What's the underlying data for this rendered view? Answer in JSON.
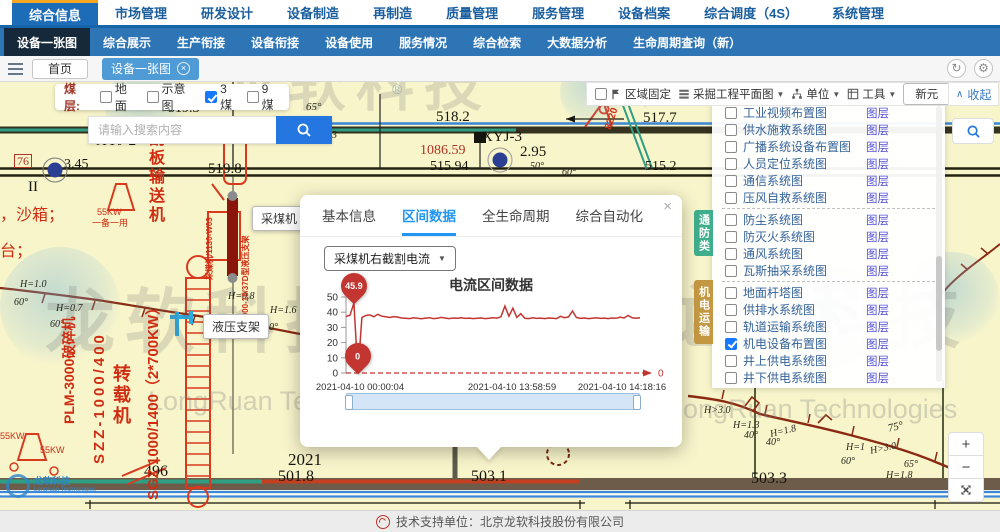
{
  "window": {
    "refresh_icon": "↻",
    "gear_icon": "⚙"
  },
  "top_nav": {
    "items": [
      {
        "label": "综合信息",
        "active": true
      },
      {
        "label": "市场管理",
        "active": false
      },
      {
        "label": "研发设计",
        "active": false
      },
      {
        "label": "设备制造",
        "active": false
      },
      {
        "label": "再制造",
        "active": false
      },
      {
        "label": "质量管理",
        "active": false
      },
      {
        "label": "服务管理",
        "active": false
      },
      {
        "label": "设备档案",
        "active": false
      },
      {
        "label": "综合调度（4S）",
        "active": false
      },
      {
        "label": "系统管理",
        "active": false
      }
    ]
  },
  "sub_nav": {
    "items": [
      {
        "label": "设备一张图",
        "active": true
      },
      {
        "label": "综合展示",
        "active": false
      },
      {
        "label": "生产衔接",
        "active": false
      },
      {
        "label": "设备衔接",
        "active": false
      },
      {
        "label": "设备使用",
        "active": false
      },
      {
        "label": "服务情况",
        "active": false
      },
      {
        "label": "综合检索",
        "active": false
      },
      {
        "label": "大数据分析",
        "active": false
      },
      {
        "label": "生命周期查询（新）",
        "active": false
      }
    ]
  },
  "tab_bar": {
    "tabs": [
      {
        "label": "首页",
        "active": false
      },
      {
        "label": "设备一张图",
        "active": true
      }
    ]
  },
  "coal_seam": {
    "label": "煤层:",
    "options": [
      {
        "label": "地面",
        "checked": false
      },
      {
        "label": "示意图",
        "checked": false
      },
      {
        "label": "3煤",
        "checked": true
      },
      {
        "label": "9煤",
        "checked": false
      }
    ]
  },
  "search": {
    "placeholder": "请输入搜索内容"
  },
  "map_toolbar": {
    "fix_label": "区域固定",
    "plan_label": "采掘工程平面图",
    "unit_label": "单位",
    "tools_label": "工具",
    "new_button": "新元",
    "collapse_label": "收起"
  },
  "layer_panel": {
    "link_label": "图层",
    "items": [
      {
        "label": "工业视频布置图",
        "checked": false,
        "divider": false
      },
      {
        "label": "供水施救系统图",
        "checked": false,
        "divider": false
      },
      {
        "label": "广播系统设备布置图",
        "checked": false,
        "divider": false
      },
      {
        "label": "人员定位系统图",
        "checked": false,
        "divider": false
      },
      {
        "label": "通信系统图",
        "checked": false,
        "divider": false
      },
      {
        "label": "压风自救系统图",
        "checked": false,
        "divider": true
      },
      {
        "label": "防尘系统图",
        "checked": false,
        "divider": false
      },
      {
        "label": "防灭火系统图",
        "checked": false,
        "divider": false
      },
      {
        "label": "通风系统图",
        "checked": false,
        "divider": false
      },
      {
        "label": "瓦斯抽采系统图",
        "checked": false,
        "divider": true
      },
      {
        "label": "地面杆塔图",
        "checked": false,
        "divider": false
      },
      {
        "label": "供排水系统图",
        "checked": false,
        "divider": false
      },
      {
        "label": "轨道运输系统图",
        "checked": false,
        "divider": false
      },
      {
        "label": "机电设备布置图",
        "checked": true,
        "divider": false
      },
      {
        "label": "井上供电系统图",
        "checked": false,
        "divider": false
      },
      {
        "label": "井下供电系统图",
        "checked": false,
        "divider": false
      }
    ],
    "category_tabs": [
      {
        "label": "通防类"
      },
      {
        "label": "机电运输"
      }
    ]
  },
  "data_panel": {
    "tabs": [
      {
        "label": "基本信息",
        "active": false
      },
      {
        "label": "区间数据",
        "active": true
      },
      {
        "label": "全生命周期",
        "active": false
      },
      {
        "label": "综合自动化",
        "active": false
      }
    ],
    "dropdown_value": "采煤机右截割电流",
    "close_label": "×"
  },
  "chart_data": {
    "type": "line",
    "title": "电流区间数据",
    "x_labels": [
      "2021-04-10 00:00:04",
      "2021-04-10 13:58:59",
      "2021-04-10 14:18:16"
    ],
    "y_ticks": [
      0,
      10,
      20,
      30,
      40,
      50
    ],
    "ylim": [
      0,
      50
    ],
    "max_label": "45.9",
    "min_label": "0",
    "axis_end_label": "0",
    "line_color": "#c23531",
    "values": [
      37.2,
      38,
      45.9,
      0,
      36.5,
      37.8,
      38.2,
      37,
      38.6,
      37.4,
      37,
      36.5,
      37.1,
      36.8,
      36.2,
      36,
      35.8,
      36.3,
      36,
      35.7,
      36.1,
      36.4,
      35.8,
      36,
      36.6,
      36.1,
      35.8,
      36.2,
      36,
      36.3,
      35.9,
      36.1,
      35.8,
      36,
      36.2,
      35.8,
      36,
      36.4,
      36.1,
      37,
      44,
      37.4,
      42.6,
      36.6,
      39,
      36,
      35.8,
      36.3,
      35.9,
      36.1,
      35.8,
      36.2,
      36,
      35.8,
      37.3,
      36.4,
      36.9,
      40.8,
      36.5,
      35.9,
      36.2,
      35.8,
      36,
      36.3,
      35.9,
      36.1,
      35.8,
      36.2,
      36,
      36.8,
      36.2,
      37.8,
      36.3,
      36,
      36.4
    ]
  },
  "map": {
    "tooltips": [
      {
        "t": "采煤机",
        "x": 252,
        "y": 124
      },
      {
        "t": "液压支架",
        "x": 203,
        "y": 232
      }
    ],
    "labels": [
      {
        "t": "519.3",
        "x": 168,
        "y": 20,
        "cls": "num",
        "s": 14
      },
      {
        "t": "65°",
        "x": 306,
        "y": 20,
        "cls": "ann",
        "s": 11
      },
      {
        "t": "518.2",
        "x": 436,
        "y": 28,
        "cls": "num",
        "s": 15
      },
      {
        "t": "517.7",
        "x": 643,
        "y": 29,
        "cls": "num",
        "s": 15
      },
      {
        "t": "H=1.3",
        "x": 308,
        "y": 48,
        "cls": "ann",
        "s": 11
      },
      {
        "t": "XYJ-2",
        "x": 96,
        "y": 52,
        "cls": "num",
        "s": 15
      },
      {
        "t": "XYJ-3",
        "x": 482,
        "y": 48,
        "cls": "num",
        "s": 15
      },
      {
        "t": "1086.59",
        "x": 420,
        "y": 62,
        "cls": "num red",
        "s": 14
      },
      {
        "t": "2.95",
        "x": 520,
        "y": 63,
        "cls": "num",
        "s": 15
      },
      {
        "t": "76",
        "x": 14,
        "y": 72,
        "cls": "num red box",
        "s": 12
      },
      {
        "t": "3.45",
        "x": 64,
        "y": 76,
        "cls": "num",
        "s": 14
      },
      {
        "t": "515.94",
        "x": 430,
        "y": 78,
        "cls": "num",
        "s": 14
      },
      {
        "t": "515.2",
        "x": 645,
        "y": 78,
        "cls": "num",
        "s": 14
      },
      {
        "t": "50°",
        "x": 530,
        "y": 80,
        "cls": "ann",
        "s": 10
      },
      {
        "t": "60°",
        "x": 562,
        "y": 86,
        "cls": "ann",
        "s": 10
      },
      {
        "t": "519.8",
        "x": 208,
        "y": 80,
        "cls": "num",
        "s": 15
      },
      {
        "t": "II",
        "x": 28,
        "y": 98,
        "cls": "num",
        "s": 15
      },
      {
        "t": "，沙箱；",
        "x": 0,
        "y": 126,
        "cls": "red-label",
        "s": 16
      },
      {
        "t": "台；",
        "x": 0,
        "y": 162,
        "cls": "red-label",
        "s": 16
      },
      {
        "t": "55KW",
        "x": 97,
        "y": 126,
        "cls": "red-label",
        "s": 9
      },
      {
        "t": "一备一用",
        "x": 92,
        "y": 137,
        "cls": "red-label",
        "s": 9
      },
      {
        "t": "H=1.0",
        "x": 20,
        "y": 198,
        "cls": "ann",
        "s": 10
      },
      {
        "t": "60°",
        "x": 14,
        "y": 216,
        "cls": "ann",
        "s": 10
      },
      {
        "t": "H=0.7",
        "x": 56,
        "y": 222,
        "cls": "ann",
        "s": 10
      },
      {
        "t": "60°",
        "x": 50,
        "y": 238,
        "cls": "ann",
        "s": 10
      },
      {
        "t": "H=0.8",
        "x": 228,
        "y": 210,
        "cls": "ann",
        "s": 10
      },
      {
        "t": "H=1.6",
        "x": 270,
        "y": 224,
        "cls": "ann",
        "s": 10
      },
      {
        "t": "60°",
        "x": 264,
        "y": 241,
        "cls": "ann",
        "s": 10
      },
      {
        "t": "55KW",
        "x": 0,
        "y": 350,
        "cls": "red-label",
        "s": 9
      },
      {
        "t": "55KW",
        "x": 40,
        "y": 364,
        "cls": "red-label",
        "s": 9
      },
      {
        "t": "496",
        "x": 144,
        "y": 382,
        "cls": "num",
        "s": 16
      },
      {
        "t": "2021",
        "x": 288,
        "y": 369,
        "cls": "num",
        "s": 17
      },
      {
        "t": "501.8",
        "x": 278,
        "y": 387,
        "cls": "num",
        "s": 16
      },
      {
        "t": "503.1",
        "x": 471,
        "y": 387,
        "cls": "num",
        "s": 16
      },
      {
        "t": "503.3",
        "x": 751,
        "y": 389,
        "cls": "num",
        "s": 16
      },
      {
        "t": "70°",
        "x": 724,
        "y": 299,
        "cls": "ann",
        "s": 10
      },
      {
        "t": "H>3.0",
        "x": 704,
        "y": 324,
        "cls": "ann",
        "s": 10
      },
      {
        "t": "H=1.3",
        "x": 733,
        "y": 339,
        "cls": "ann",
        "s": 10
      },
      {
        "t": "40°",
        "x": 744,
        "y": 349,
        "cls": "ann",
        "s": 10
      },
      {
        "t": "H=1.8",
        "x": 770,
        "y": 345,
        "cls": "ann",
        "s": 10,
        "rot": -14
      },
      {
        "t": "40°",
        "x": 766,
        "y": 356,
        "cls": "ann",
        "s": 10
      },
      {
        "t": "H=1",
        "x": 846,
        "y": 361,
        "cls": "ann",
        "s": 10
      },
      {
        "t": "60°",
        "x": 841,
        "y": 375,
        "cls": "ann",
        "s": 10
      },
      {
        "t": "H>3.0",
        "x": 870,
        "y": 362,
        "cls": "ann",
        "s": 10,
        "rot": -12
      },
      {
        "t": "75°",
        "x": 888,
        "y": 340,
        "cls": "ann",
        "s": 11,
        "rot": -14
      },
      {
        "t": "65°",
        "x": 904,
        "y": 378,
        "cls": "ann",
        "s": 10
      },
      {
        "t": "H=1.8",
        "x": 886,
        "y": 389,
        "cls": "ann",
        "s": 10
      },
      {
        "t": "刮板输送机",
        "x": 146,
        "y": 48,
        "cls": "vcjk red-label",
        "s": 16
      },
      {
        "t": "转载机",
        "x": 112,
        "y": 282,
        "cls": "vcjk red-label",
        "s": 18
      },
      {
        "t": "SGZ 1000/1400（2*700KW）",
        "x": 146,
        "y": 418,
        "cls": "vrot red-label",
        "s": 15,
        "rot": -90
      },
      {
        "t": "SZZ-1000/400",
        "x": 92,
        "y": 382,
        "cls": "vrot red-label sp",
        "s": 15,
        "rot": -90
      },
      {
        "t": "PLM-3000破碎机",
        "x": 62,
        "y": 342,
        "cls": "vrot red-label",
        "s": 14,
        "rot": -90
      },
      {
        "t": "采煤机/1130-W03",
        "x": 206,
        "y": 198,
        "cls": "vrot red-label",
        "s": 8,
        "rot": -90
      },
      {
        "t": "ZY8000-18/37D型液压支架",
        "x": 242,
        "y": 250,
        "cls": "vrot red-label",
        "s": 8,
        "rot": -90
      },
      {
        "t": "8220",
        "x": 604,
        "y": 46,
        "cls": "vrot red-label",
        "s": 10,
        "rot": -72
      }
    ]
  },
  "watermark": {
    "cn": "龙软科技",
    "en": "LongRuan Technologies",
    "reg": "®"
  },
  "zoom_controls": {
    "zoom_in": "+",
    "zoom_out": "−"
  },
  "corner_logo": {
    "cn": "龙软科技",
    "en": "Longruan Technologies"
  },
  "footer": {
    "text": "技术支持单位：北京龙软科技股份有限公司"
  }
}
